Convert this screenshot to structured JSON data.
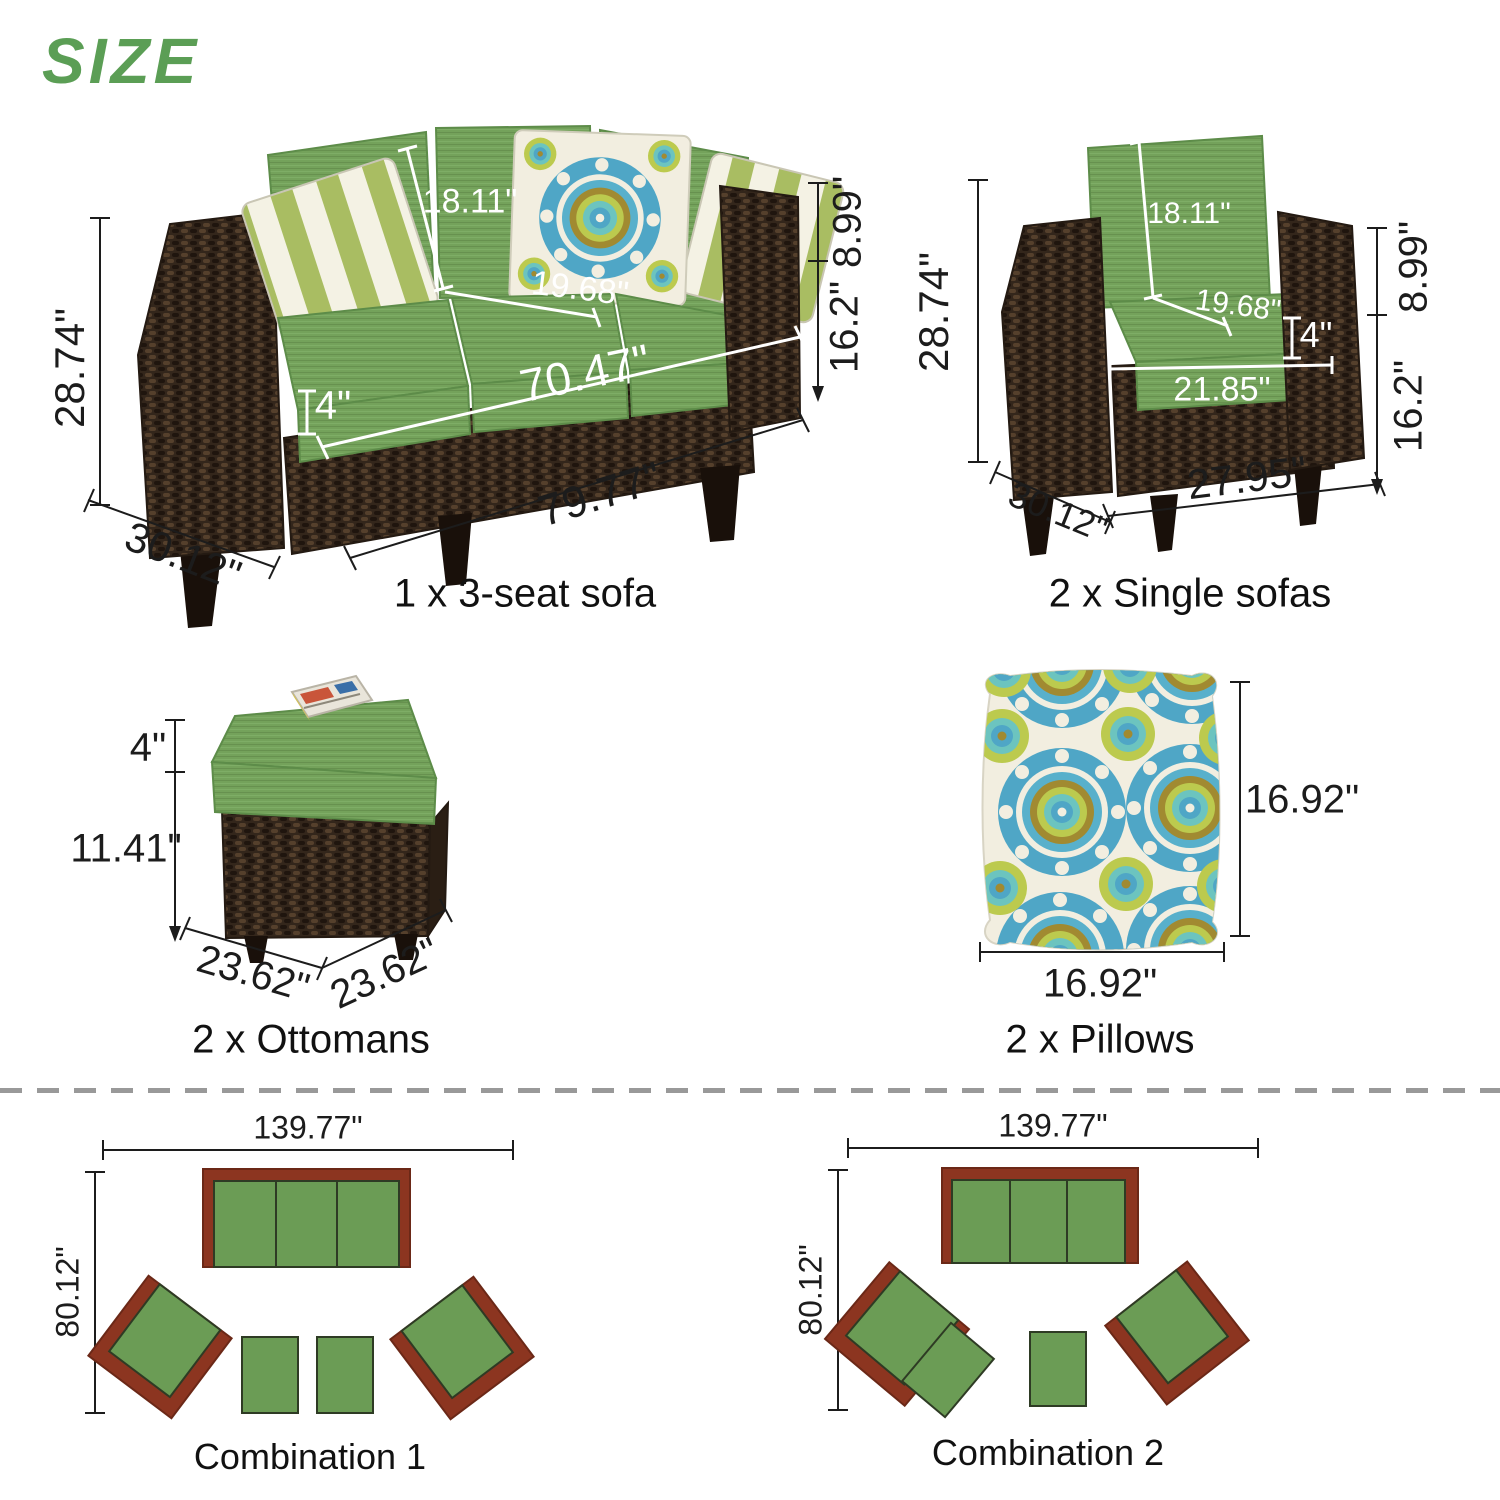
{
  "title": "SIZE",
  "colors": {
    "accent_green": "#5b9e55",
    "cushion_green": "#74a25b",
    "wicker_brown": "#33261b",
    "diagram_green": "#6b9c55",
    "diagram_frame_brown": "#8c3520",
    "pillow_blue": "#4fa6c6",
    "pillow_lime": "#bcca4e",
    "dimension_text": "#1c1c1c"
  },
  "sofa3": {
    "label": "1 x 3-seat sofa",
    "back_cushion_height": "18.11\"",
    "seat_depth": "19.68\"",
    "seat_width": "70.47\"",
    "cushion_thickness": "4\"",
    "overall_height": "28.74\"",
    "overall_depth": "30.12\"",
    "overall_width": "79.77\"",
    "back_height": "8.99\"",
    "seat_height": "16.2\""
  },
  "single_sofa": {
    "label": "2 x Single sofas",
    "back_cushion_height": "18.11\"",
    "seat_depth": "19.68\"",
    "cushion_thickness": "4\"",
    "seat_width": "21.85\"",
    "overall_height": "28.74\"",
    "overall_depth": "30.12\"",
    "overall_width": "27.95\"",
    "back_height": "8.99\"",
    "seat_height": "16.2\""
  },
  "ottoman": {
    "label": "2 x Ottomans",
    "cushion_thickness": "4\"",
    "base_height": "11.41\"",
    "width": "23.62\"",
    "depth": "23.62\""
  },
  "pillow": {
    "label": "2 x Pillows",
    "width": "16.92\"",
    "height": "16.92\""
  },
  "combination1": {
    "label": "Combination 1",
    "width": "139.77\"",
    "depth": "80.12\""
  },
  "combination2": {
    "label": "Combination 2",
    "width": "139.77\"",
    "depth": "80.12\""
  }
}
